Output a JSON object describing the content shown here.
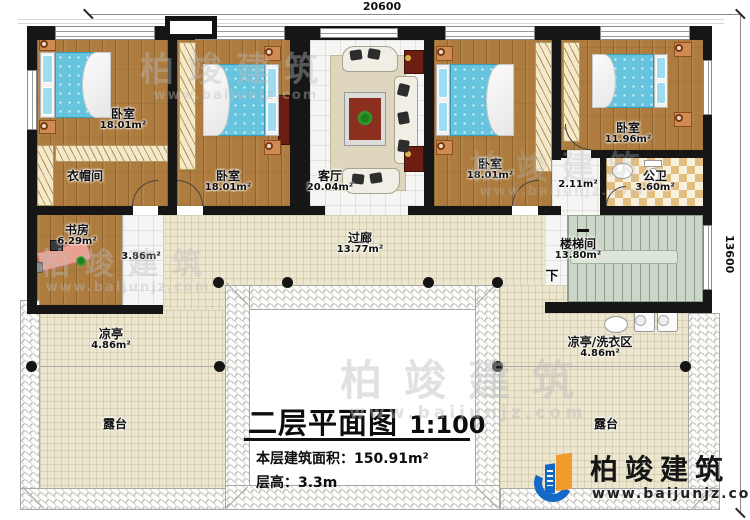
{
  "dimensions": {
    "top": "20600",
    "right": "13600"
  },
  "title_block": {
    "title": "二层平面图",
    "scale": "1:100",
    "area_label": "本层建筑面积：",
    "area_value": "150.91m²",
    "height_label": "层高：",
    "height_value": "3.3m"
  },
  "rooms": {
    "bedroom1": {
      "name": "卧室",
      "area": "18.01m²"
    },
    "bedroom2": {
      "name": "卧室",
      "area": "18.01m²"
    },
    "bedroom3": {
      "name": "卧室",
      "area": "18.01m²"
    },
    "bedroom4": {
      "name": "卧室",
      "area": "11.96m²"
    },
    "cloakroom": {
      "name": "衣帽间"
    },
    "study": {
      "name": "书房",
      "area": "6.29m²"
    },
    "study_annex": {
      "area": "3.86m²"
    },
    "living_room": {
      "name": "客厅",
      "area": "20.04m²"
    },
    "corridor": {
      "name": "过廊",
      "area": "13.77m²"
    },
    "hall": {
      "area": "2.11m²"
    },
    "bathroom": {
      "name": "公卫",
      "area": "3.60m²"
    },
    "stairwell": {
      "name": "楼梯间",
      "area": "13.80m²",
      "direction": "下"
    },
    "pavilion_left": {
      "name": "凉亭",
      "area": "4.86m²"
    },
    "pavilion_laundry": {
      "name": "凉亭/洗衣区",
      "area": "4.86m²"
    },
    "terrace_left": {
      "name": "露台"
    },
    "terrace_right": {
      "name": "露台"
    }
  },
  "brand": {
    "name": "柏竣建筑",
    "url": "www.baijunjz.com"
  },
  "watermark": {
    "name": "柏竣建筑",
    "url": "www.baijunjz.com"
  },
  "colors": {
    "wall": "#161616",
    "wood_floor": "#ad7c3e",
    "bed": "#66c4de",
    "tile_cream": "#ece6cf",
    "stair_green": "#ccd7c9",
    "cabinet_red": "#6e1d12",
    "brand_blue": "#1468c8",
    "brand_orange": "#f29a2e"
  }
}
